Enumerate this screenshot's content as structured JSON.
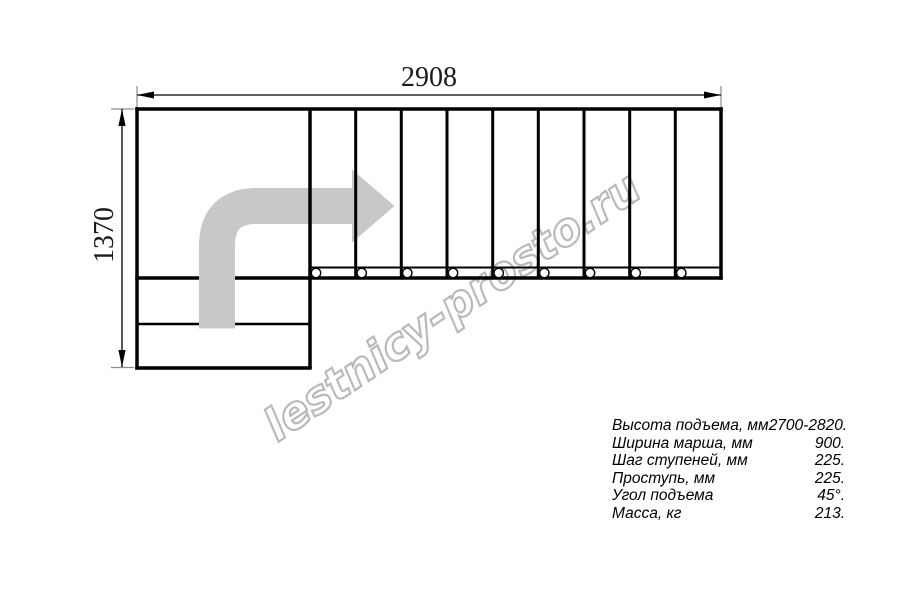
{
  "watermark": {
    "text": "lestnicy-prosto.ru",
    "color": "#b9b9b9"
  },
  "dimensions": {
    "width_label": "2908",
    "height_label": "1370"
  },
  "drawing": {
    "type": "stair-plan-top-view",
    "line_color": "#000000",
    "arrow_color": "#c8c8c8",
    "flight_step_columns": 9,
    "tread_circles": 9,
    "bottom_entry_steps": 2
  },
  "specs": {
    "rows": [
      {
        "label": "Высота подъема, мм",
        "value": "2700-2820."
      },
      {
        "label": "Ширина марша, мм",
        "value": "900."
      },
      {
        "label": "Шаг ступеней, мм",
        "value": "225."
      },
      {
        "label": "Проступь, мм",
        "value": "225."
      },
      {
        "label": "Угол подъема",
        "value": "45°."
      },
      {
        "label": "Масса, кг",
        "value": "213."
      }
    ]
  }
}
